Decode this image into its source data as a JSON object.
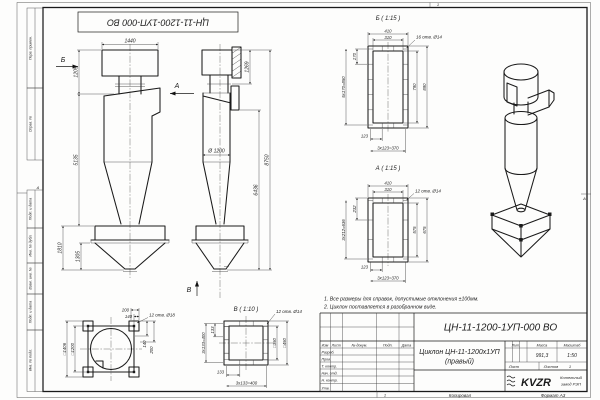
{
  "stamp": {
    "text": "ЦН-11-1200-1УП-000 ВО"
  },
  "frame": {
    "strips": [
      {
        "label": "Перв. примен."
      },
      {
        "label": "Справ. №"
      },
      {
        "label": "Подп. и дата"
      },
      {
        "label": "Инв. № дубл."
      },
      {
        "label": "Взам. инв. №"
      },
      {
        "label": "Подп. и дата"
      },
      {
        "label": "Инв. № подл."
      }
    ],
    "zones": {
      "top": "1",
      "bottom": "1",
      "left": "А",
      "right": "А"
    }
  },
  "views": {
    "front": {
      "dim_width": "1440",
      "dim_h1": "1205",
      "dim_h2": "5135",
      "dim_h3": "1810",
      "dim_h4": "1305",
      "arrow_b": "Б",
      "arrow_a": "А"
    },
    "side": {
      "dia": "Ø 1200",
      "dim_h1": "1269",
      "dim_h2": "6436",
      "dim_total": "8750",
      "arrow_v": "В"
    },
    "sec_b": {
      "title": "Б ( 1:15 )",
      "holes": "16 отв. Ø14",
      "w_out": "410",
      "w_in": "310",
      "h_in": "790",
      "h_out": "890",
      "pitch_v": "170",
      "pitch_v_sum": "5x170=850",
      "pitch_h": "123",
      "pitch_h_sum": "3x123=370"
    },
    "sec_a": {
      "title": "А ( 1:15 )",
      "holes": "12 отв. Ø14",
      "w_out": "410",
      "w_in": "310",
      "h_in": "575",
      "h_out": "675",
      "pitch_v": "232",
      "pitch_v_sum": "3x212=636",
      "pitch_h": "123",
      "pitch_h_sum": "3x123=370"
    },
    "sec_v": {
      "title": "В ( 1:10 )",
      "holes": "12 отв. Ø14",
      "sq_in": "□350",
      "sq_out": "□450",
      "pitch_v": "133",
      "pitch_v_sum": "3x133=400",
      "pitch_h": "133",
      "pitch_h_sum": "3x133=400"
    },
    "plan": {
      "holes": "12 отв. Ø18",
      "dim_t1": "200",
      "dim_t2": "140",
      "dim_r1": "140",
      "dim_r2": "200",
      "sq_out": "□1406",
      "sq_in": "□1200"
    }
  },
  "notes": [
    "1. Все размеры для справок, допустимые отклонения ±100мм.",
    "2. Циклон поставляется в разобранном виде."
  ],
  "title_block": {
    "doc_number": "ЦН-11-1200-1УП-000 ВО",
    "name_line1": "Циклон ЦН-11-1200х1УП",
    "name_line2": "(правый)",
    "header_cols": [
      "Изм",
      "Лист",
      "№ докум.",
      "Подп.",
      "Дата"
    ],
    "rows": [
      "Разраб.",
      "Пров.",
      "Т. контр.",
      "Нач. отд.",
      "Н. контр.",
      "Утв."
    ],
    "lit_label": "Лит.",
    "mass_label": "Масса",
    "scale_label": "Масштаб",
    "mass": "991,3",
    "scale": "1:50",
    "sheet_label": "Лист",
    "sheets_label": "Листов",
    "sheets_value": "1",
    "logo_text": "KVZR",
    "org_line1": "Котельный",
    "org_line2": "завод РЭП",
    "copied_label": "Копировал",
    "format_label": "Формат А3"
  }
}
